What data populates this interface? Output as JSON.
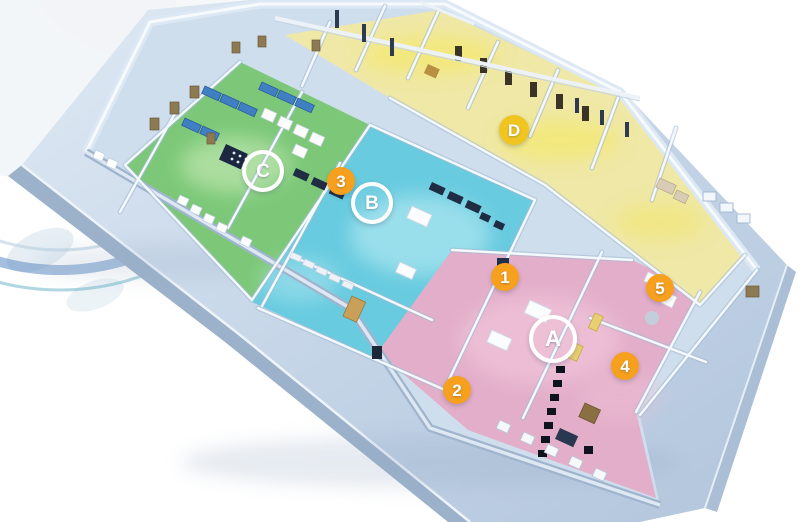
{
  "scene": {
    "description": "3D isometric cutaway rendering of a laboratory / clinic floor plan on a light blue base slab, with four color-coded areas and circular callout markers",
    "background_color": "#ffffff"
  },
  "palette": {
    "platform_top": "#c6d6e8",
    "platform_side": "#9cb1ca",
    "interior_floor": "#cfdeed",
    "wall_highlight": "#f4f9fd",
    "wall_shadow": "#a3b9d2",
    "zone_a_pink": "#e3aec9",
    "zone_b_cyan": "#68cbdf",
    "zone_c_green": "#7cc878",
    "zone_d_yellow": "#efe8a6",
    "marker_orange": "#f6a01e",
    "marker_yellow": "#f0c520",
    "marker_ring": "#ffffff",
    "furniture_navy": "#1f2c44",
    "bed_blue": "#3f7fc2",
    "door_brown": "#8d7a52",
    "globe_arc_blue": "#4d7fbd"
  },
  "zones": [
    {
      "id": "A",
      "color_name": "pink",
      "color": "#e3aec9"
    },
    {
      "id": "B",
      "color_name": "cyan",
      "color": "#68cbdf"
    },
    {
      "id": "C",
      "color_name": "green",
      "color": "#7cc878"
    },
    {
      "id": "D",
      "color_name": "yellow",
      "color": "#efe8a6"
    }
  ],
  "markers": [
    {
      "label": "A",
      "kind": "area",
      "style": "ring",
      "x": 553,
      "y": 339,
      "size": 40,
      "font": 22
    },
    {
      "label": "B",
      "kind": "area",
      "style": "ring",
      "x": 372,
      "y": 203,
      "size": 34,
      "font": 19
    },
    {
      "label": "C",
      "kind": "area",
      "style": "ring",
      "x": 263,
      "y": 171,
      "size": 34,
      "font": 19
    },
    {
      "label": "D",
      "kind": "area",
      "style": "filled-yellow",
      "x": 514,
      "y": 130,
      "size": 30,
      "font": 17
    },
    {
      "label": "1",
      "kind": "room",
      "style": "filled-orange",
      "x": 505,
      "y": 277,
      "size": 28,
      "font": 17
    },
    {
      "label": "2",
      "kind": "room",
      "style": "filled-orange",
      "x": 457,
      "y": 390,
      "size": 28,
      "font": 17
    },
    {
      "label": "3",
      "kind": "room",
      "style": "filled-orange",
      "x": 341,
      "y": 181,
      "size": 28,
      "font": 17
    },
    {
      "label": "4",
      "kind": "room",
      "style": "filled-orange",
      "x": 625,
      "y": 366,
      "size": 28,
      "font": 17
    },
    {
      "label": "5",
      "kind": "room",
      "style": "filled-orange",
      "x": 660,
      "y": 288,
      "size": 28,
      "font": 17
    }
  ]
}
